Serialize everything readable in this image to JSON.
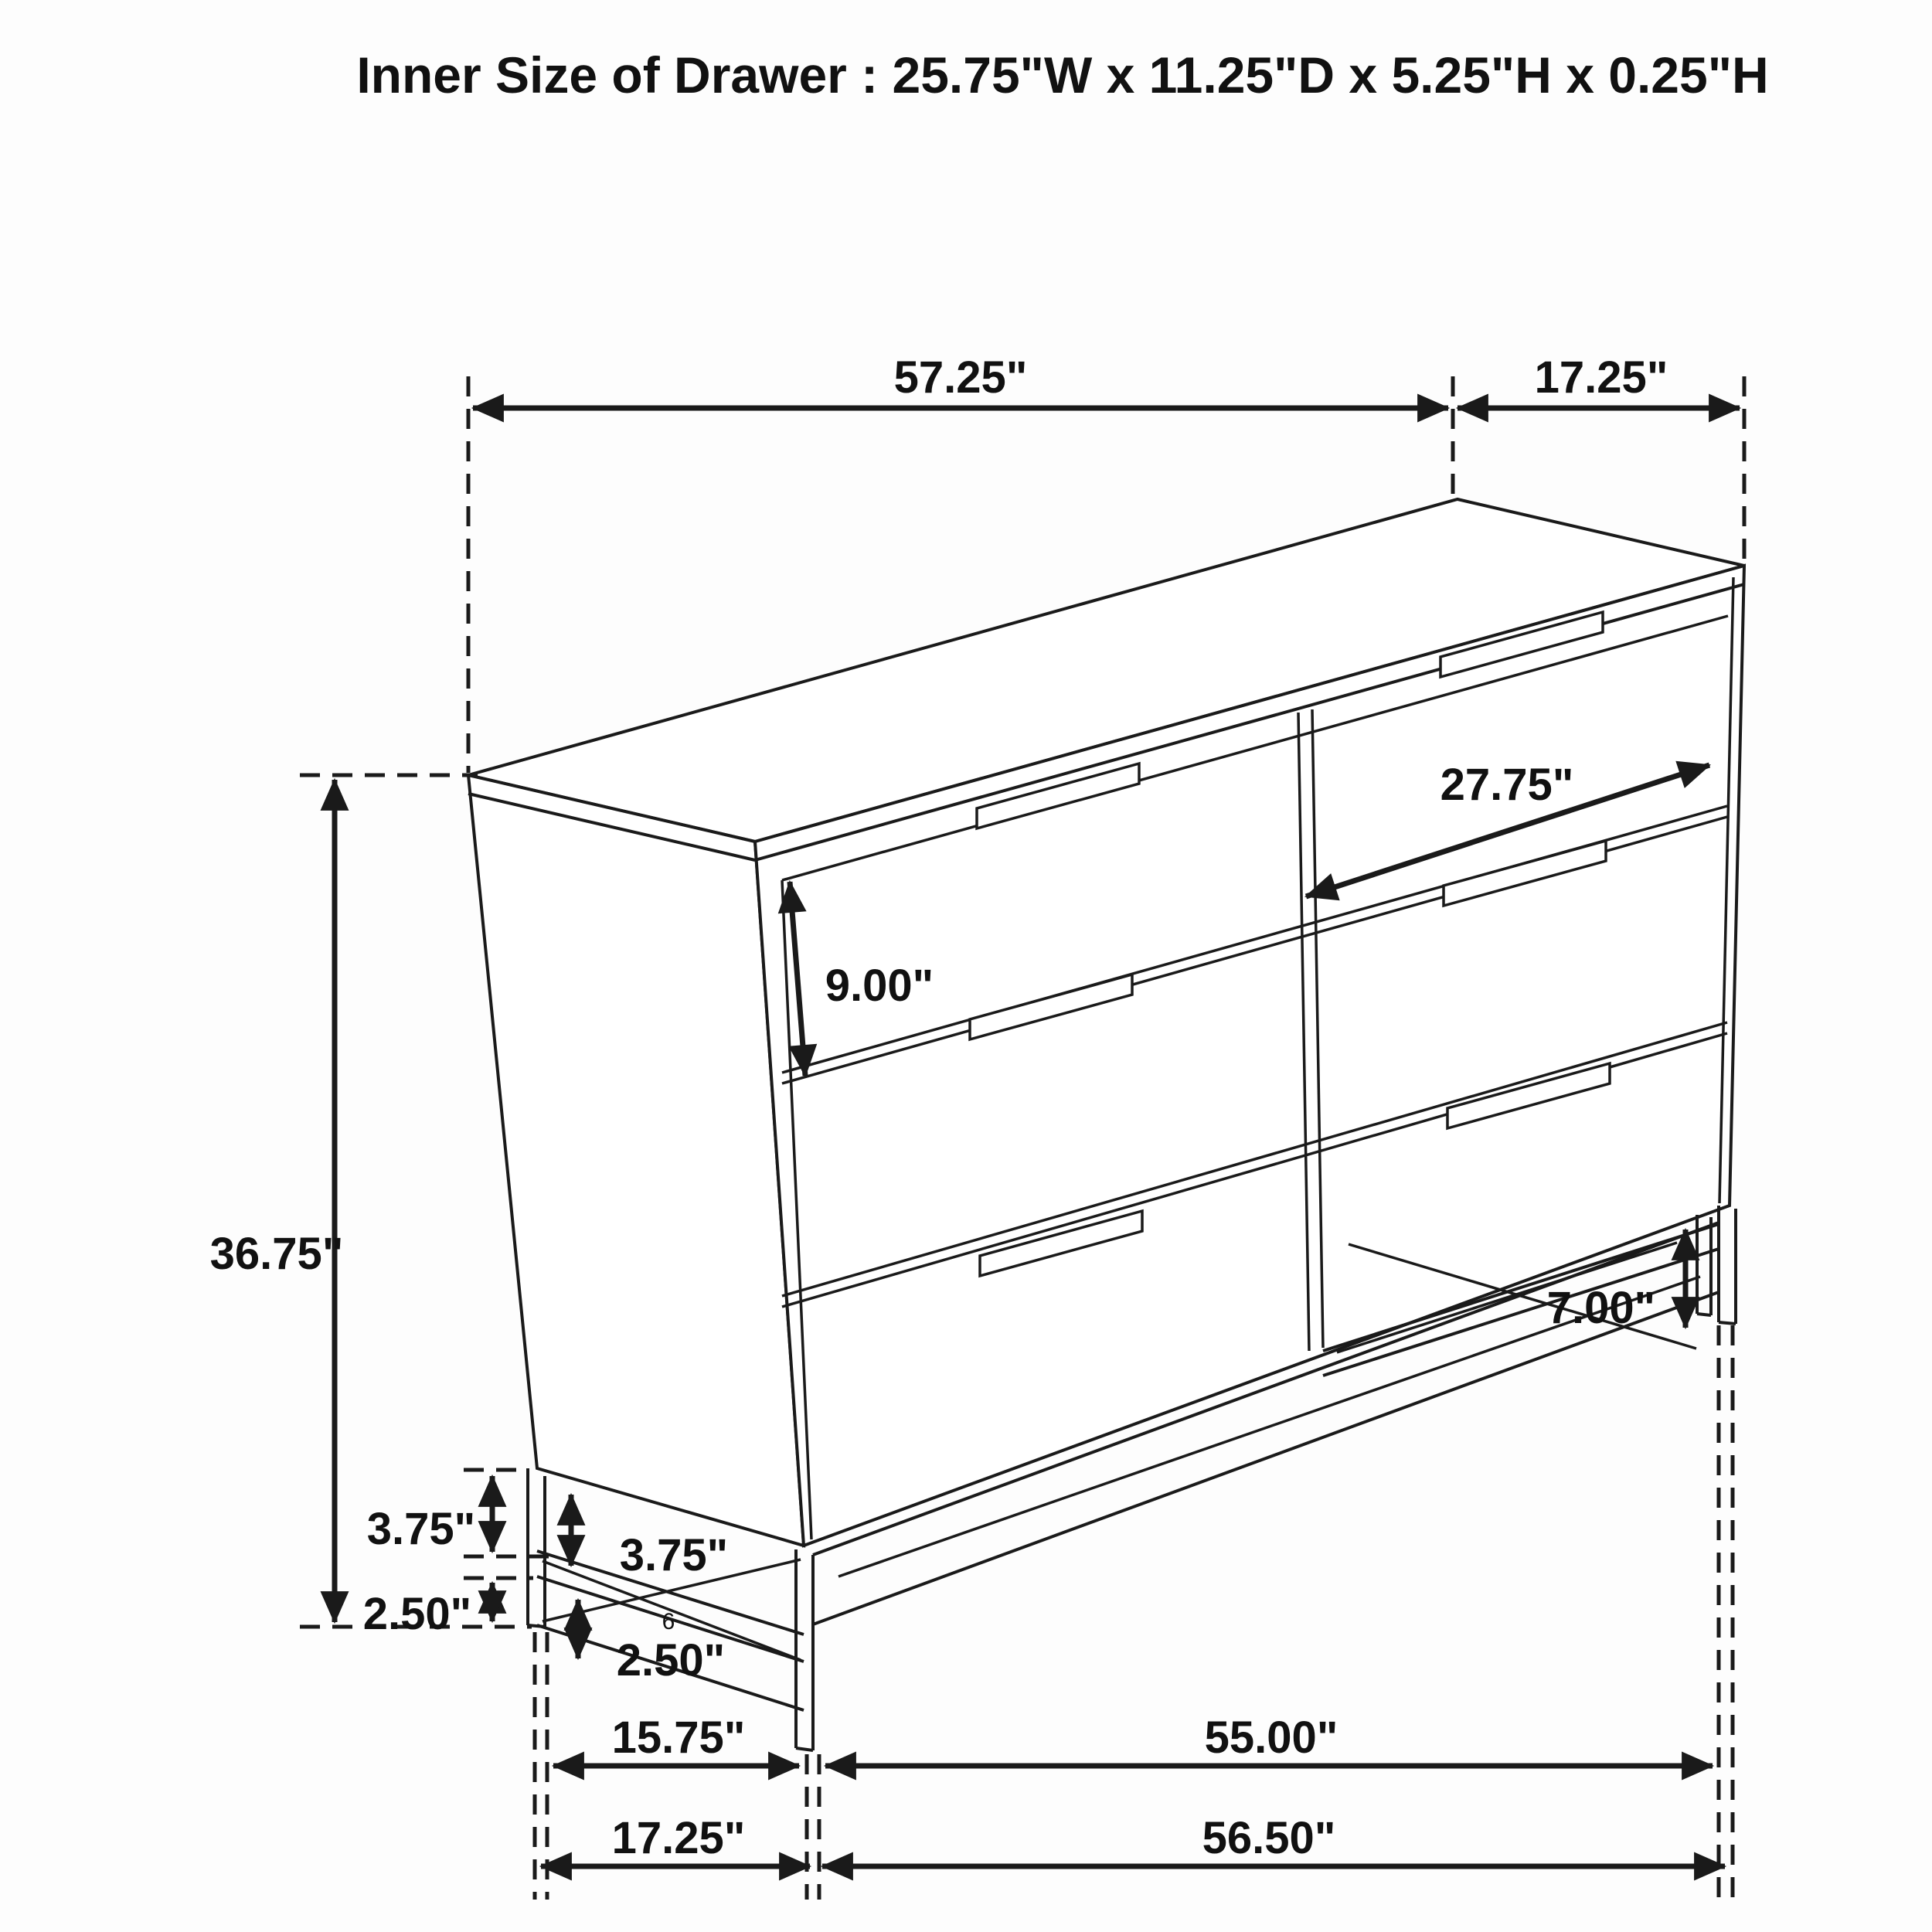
{
  "title": "Inner Size of Drawer : 25.75\"W x 11.25\"D x 5.25\"H x 0.25\"H",
  "colors": {
    "ink": "#1a1a1a",
    "background": "#ffffff"
  },
  "dimensions": {
    "top_width": "57.25\"",
    "top_depth": "17.25\"",
    "overall_height": "36.75\"",
    "drawer_front_height": "9.00\"",
    "drawer_diagonal": "27.75\"",
    "leg_height": "7.00\"",
    "side_rail_height": "3.75\"",
    "front_rail_height": "3.75\"",
    "side_stretcher_height": "2.50\"",
    "front_stretcher_height": "2.50\"",
    "base_depth_inner": "15.75\"",
    "base_width_inner": "55.00\"",
    "base_depth_outer": "17.25\"",
    "base_width_outer": "56.50\""
  },
  "stray_mark": "6"
}
